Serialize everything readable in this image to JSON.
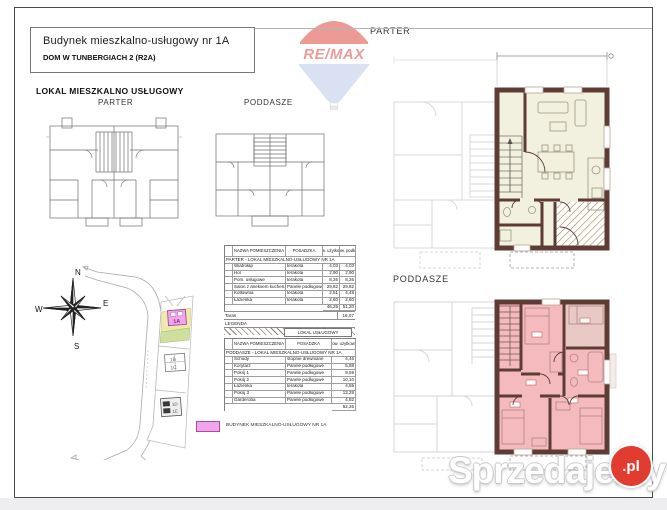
{
  "header": {
    "title_line1": "Budynek mieszkalno-usługowy nr 1A",
    "title_line2": "DOM W TUNBERGIACH 2 (R2A)",
    "remax_text": "RE/MAX"
  },
  "left_panel": {
    "section_title": "LOKAL MIESZKALNO  USŁUGOWY",
    "small_parter_label": "PARTER",
    "small_poddasze_label": "PODDASZE",
    "compass": {
      "n": "N",
      "e": "E",
      "s": "S",
      "w": "W"
    },
    "site_buildings": {
      "b1": "1A",
      "b2": "1B",
      "b3": "1C",
      "b4": "1D",
      "b5": "1E"
    },
    "legend_building_label": "BUDYNEK MIESZKALNO-USŁUGOWY NR 1A"
  },
  "table_parter": {
    "headers": {
      "name": "NAZWA POMIESZCZENIA",
      "floor": "POSADZKA",
      "area1": "pow. użytkowa",
      "area2": "pow. podłóg"
    },
    "section_label": "PARTER - LOKAL MIESZKALNO-USŁUGOWY NR 1A",
    "rows": [
      {
        "name": "Wiatrołap",
        "floor": "terakota",
        "a1": "4,03",
        "a2": "4,03"
      },
      {
        "name": "Hol",
        "floor": "terakota",
        "a1": "2,90",
        "a2": "2,90"
      },
      {
        "name": "Pom. usługowe",
        "floor": "terakota",
        "a1": "8,26",
        "a2": "8,26"
      },
      {
        "name": "Salon z aneksem kuchen.",
        "floor": "Panele podłogowe",
        "a1": "29,82",
        "a2": "29,82"
      },
      {
        "name": "Kotłownia",
        "floor": "terakota",
        "a1": "2,51",
        "a2": "4,48"
      },
      {
        "name": "Łazienka",
        "floor": "terakota",
        "a1": "2,60",
        "a2": "2,60"
      }
    ],
    "total_a1": "46,25",
    "total_a2": "51,20",
    "taras_label": "Taras",
    "taras_value": "16,07",
    "legenda_label": "LEGENDA",
    "hatch_label": "LOKAL USŁUGOWY"
  },
  "table_poddasze": {
    "headers": {
      "name": "NAZWA POMIESZCZENIA",
      "floor": "POSADZKA",
      "area1": "pow. użytkowa"
    },
    "section_label": "PODDASZE - LOKAL MIESZKALNO-USŁUGOWY NR 1A",
    "rows": [
      {
        "name": "Schody",
        "floor": "stopnie drewniane",
        "a1": "4,46"
      },
      {
        "name": "Korytarz",
        "floor": "Panele podłogowe",
        "a1": "5,88"
      },
      {
        "name": "Pokój 1",
        "floor": "Panele podłogowe",
        "a1": "9,59"
      },
      {
        "name": "Pokój 2",
        "floor": "Panele podłogowe",
        "a1": "10,10"
      },
      {
        "name": "Łazienka",
        "floor": "terakota",
        "a1": "4,55"
      },
      {
        "name": "Pokój 3",
        "floor": "Panele podłogowe",
        "a1": "13,28"
      },
      {
        "name": "Garderoba",
        "floor": "Panele podłogowe",
        "a1": "4,82"
      }
    ],
    "total_a1": "52,26"
  },
  "right_panel": {
    "parter_label": "PARTER",
    "poddasze_label": "PODDASZE"
  },
  "watermark": {
    "text": "Sprzedajemy",
    "tld": ".pl"
  },
  "colors": {
    "wall": "#5e3c36",
    "parter_room_fill": "#f2f1df",
    "poddasze_room_fill": "#f5babd",
    "building_pink": "#f0a6ea",
    "watermark_red": "#e23b30",
    "remax_red": "#d94a44",
    "remax_blue": "#bcc9e9"
  }
}
